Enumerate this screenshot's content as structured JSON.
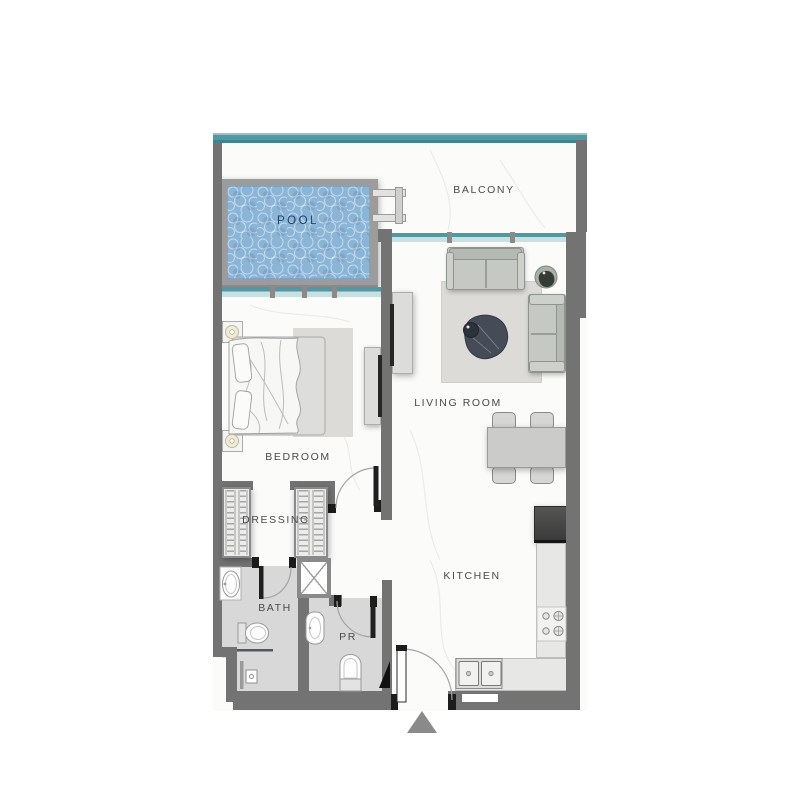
{
  "rooms": {
    "balcony": "BALCONY",
    "pool": "POOL",
    "living_room": "LIVING ROOM",
    "bedroom": "BEDROOM",
    "dressing": "DRESSING",
    "bath": "BATH",
    "powder_room": "PR",
    "kitchen": "KITCHEN"
  },
  "colors": {
    "wall": "#737373",
    "teal": "#4f99a2",
    "tealLight": "#c9e0e1",
    "water": "#8bb5d6",
    "poolFrame": "#9c9c9c",
    "floor": "#fbfbfa",
    "wetFloor": "#d8d8d8",
    "rug": "#dcdbd8",
    "sofa": "#c6c9c3",
    "furniture": "#dcdcda",
    "counter": "#e7e7e5",
    "label": "#4b4b4b",
    "poolLabel": "#1d3f66",
    "accentBlack": "#1c1c1c"
  }
}
